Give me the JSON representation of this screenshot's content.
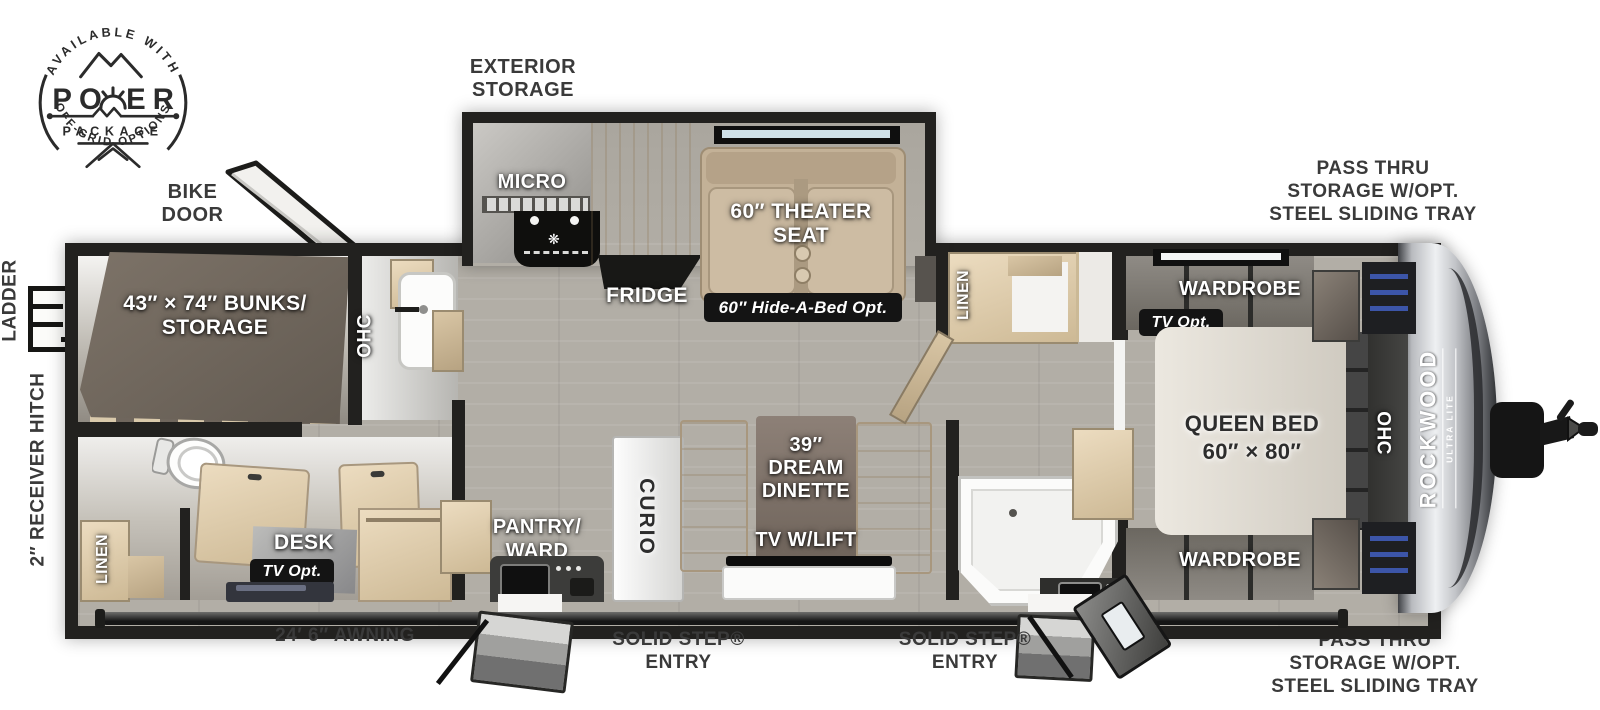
{
  "brand": {
    "name": "ROCKWOOD",
    "sub": "ULTRA LITE"
  },
  "logo": {
    "arc_top": "AVAILABLE WITH",
    "word": "POWER",
    "word_left": "PO",
    "word_right": "ER",
    "package": "PACKAGE",
    "arc_bottom": "OFF-GRID OPTIONS"
  },
  "callouts": {
    "bike_door": [
      "BIKE",
      "DOOR"
    ],
    "exterior_storage": [
      "EXTERIOR",
      "STORAGE"
    ],
    "pass_thru_front": [
      "PASS THRU",
      "STORAGE W/OPT.",
      "STEEL SLIDING TRAY"
    ],
    "pass_thru_rear": [
      "PASS THRU",
      "STORAGE W/OPT.",
      "STEEL SLIDING TRAY"
    ],
    "ladder": "LADDER",
    "receiver_hitch": "2″ RECEIVER HITCH",
    "awning": "24′ 6″ AWNING",
    "solid_step": "SOLID STEP®",
    "entry": "ENTRY"
  },
  "features": {
    "bunks": [
      "43″ × 74″ BUNKS/",
      "STORAGE"
    ],
    "ohc": "OHC",
    "linen": "LINEN",
    "desk": "DESK",
    "tv_opt": "TV Opt.",
    "micro": "MICRO",
    "fridge": "FRIDGE",
    "theater_seat": [
      "60″ THEATER",
      "SEAT"
    ],
    "hide_a_bed": "60″ Hide-A-Bed Opt.",
    "pantry": [
      "PANTRY/",
      "WARD"
    ],
    "curio": "CURIO",
    "dinette": [
      "39″",
      "DREAM",
      "DINETTE"
    ],
    "tv_lift": "TV W/LIFT",
    "wardrobe": "WARDROBE",
    "queen_bed": [
      "QUEEN BED",
      "60″ × 80″"
    ]
  },
  "colors": {
    "wall": "#22211f",
    "badge_bg": "#141414",
    "floor": "#b2aea6",
    "cabinet_tan": "#dfcfb1",
    "seat_tan": "#c3b197",
    "bunk_mattress": "#6e655c",
    "label_dark": "#3a3a3a",
    "front_cap_silver": "#d9dade",
    "wardrobe_stripe_blue": "#3c55a8"
  }
}
